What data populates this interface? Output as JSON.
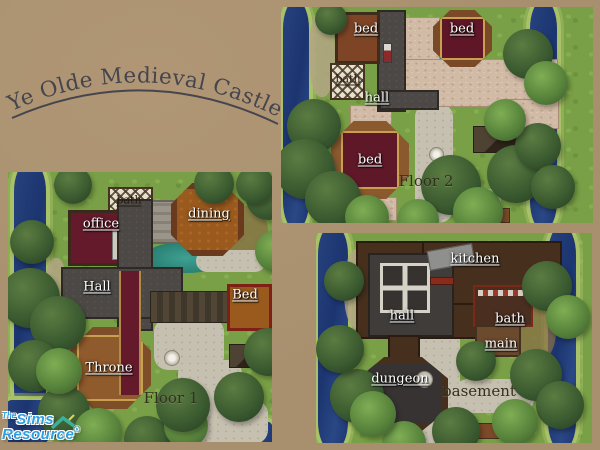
{
  "title": "Ye Olde Medieval Castle",
  "logo": {
    "the": "The",
    "sims": "Sims",
    "resource": "Resource",
    "registered": "®"
  },
  "panels": {
    "floor2": {
      "caption": "Floor 2",
      "rooms": {
        "bed_nw": "bed",
        "bed_ne": "bed",
        "bath": "bath",
        "hall": "hall",
        "bed_tower": "bed"
      }
    },
    "floor1": {
      "caption": "Floor 1",
      "rooms": {
        "bath": "bath",
        "office": "office",
        "dining": "dining",
        "hall": "Hall",
        "bed": "Bed",
        "throne": "Throne"
      }
    },
    "basement": {
      "caption": "basement",
      "rooms": {
        "kitchen": "kitchen",
        "hall": "hall",
        "bath": "bath",
        "main": "main",
        "dungeon": "dungeon"
      }
    }
  },
  "colors": {
    "page_background": "#A8906F",
    "title_text": "#45454E",
    "room_label_text": "#FFFFFF",
    "caption_text": "#33301D",
    "grass": "#79A046",
    "water": "#1D3572",
    "tree": "#3C5C31",
    "cobblestone": "#D2BBA6",
    "stone_path": "#C6C0B0",
    "pond_teal": "#2A8274",
    "carpet_red": "#651A2B",
    "wood_brown": "#7D4E28",
    "floor_orange": "#9A5A1E",
    "hall_floor_gray": "#4C4845",
    "basement_brown": "#46301D",
    "logo_blue": "#2F9FDF",
    "logo_roof_teal": "#3BB09B"
  }
}
